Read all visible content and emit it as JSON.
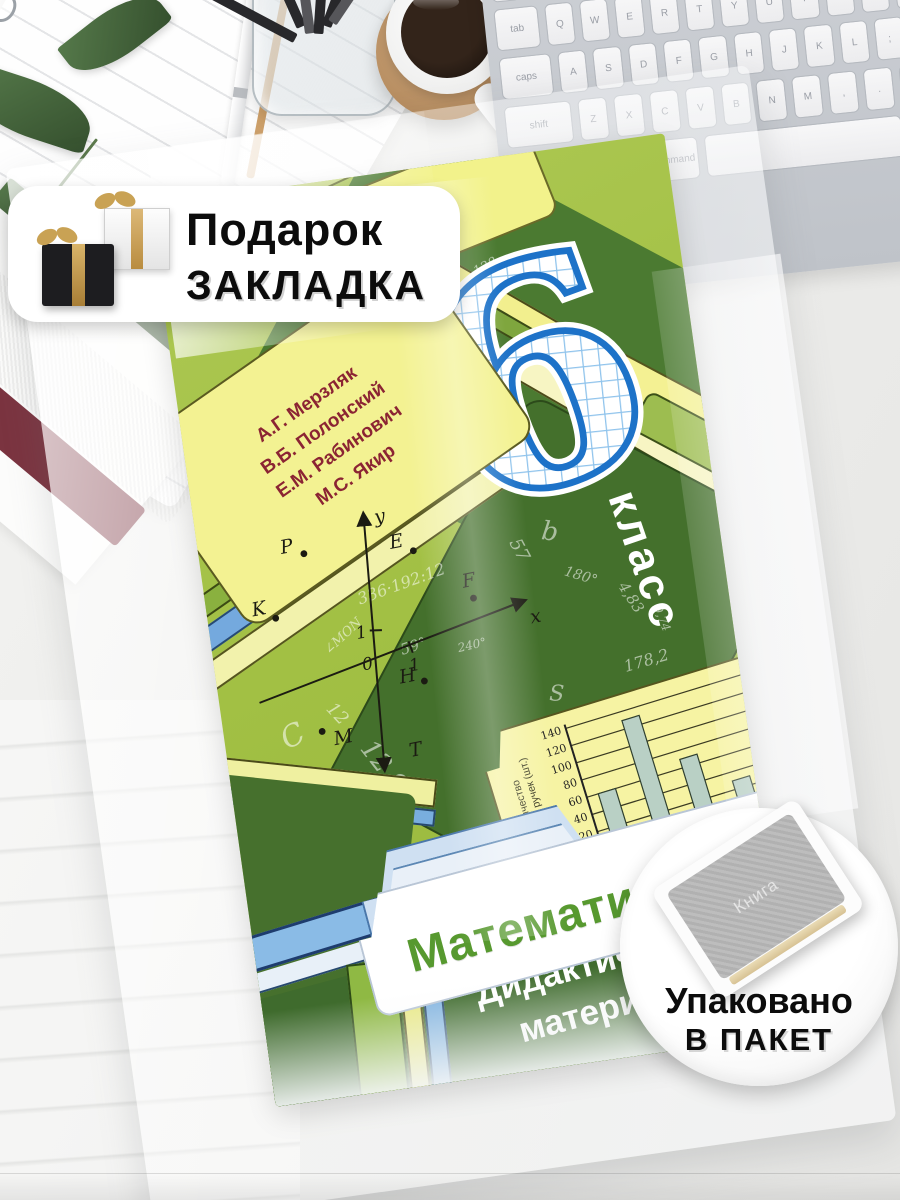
{
  "gift_badge": {
    "line1": "Подарок",
    "line2": "ЗАКЛАДКА"
  },
  "package_badge": {
    "line1": "Упаковано",
    "line2": "В ПАКЕТ",
    "wrapped_book_label": "Книга"
  },
  "book_cover": {
    "grade_number": "6",
    "grade_word": "класс",
    "authors": [
      "А.Г. Мерзляк",
      "В.Б. Полонский",
      "Е.М. Рабинович",
      "М.С. Якир"
    ],
    "title": "Математика",
    "subtitle_line1": "Дидактические",
    "subtitle_line2": "материалы",
    "plane": {
      "x_label": "x",
      "y_label": "y",
      "origin": "0",
      "unit_x": "1",
      "unit_y": "1",
      "points": [
        {
          "n": "P",
          "x": 80,
          "y": 40,
          "lx": -22,
          "ly": -4
        },
        {
          "n": "E",
          "x": 188,
          "y": 58,
          "lx": -22,
          "ly": -6
        },
        {
          "n": "K",
          "x": 40,
          "y": 98,
          "lx": -22,
          "ly": -6
        },
        {
          "n": "F",
          "x": 238,
          "y": 116,
          "lx": -8,
          "ly": -12
        },
        {
          "n": "H",
          "x": 174,
          "y": 188,
          "lx": -24,
          "ly": -2
        },
        {
          "n": "M",
          "x": 64,
          "y": 218,
          "lx": 10,
          "ly": 16
        },
        {
          "n": "T",
          "x": 134,
          "y": 254,
          "lx": 12,
          "ly": 6,
          "dot": false
        }
      ]
    },
    "bar_chart": {
      "ylabel_line1": "Количество",
      "ylabel_line2": "цветных ручек (шт.)",
      "y_ticks": [
        140,
        120,
        100,
        80,
        60,
        40,
        20
      ],
      "values": [
        60,
        130,
        70,
        30,
        65
      ]
    },
    "scatter_symbols": [
      {
        "t": "91,38",
        "x": 42,
        "y": 21,
        "r": -25,
        "s": 13
      },
      {
        "t": "128",
        "x": 60,
        "y": 11,
        "r": -20,
        "s": 13
      },
      {
        "t": "3,7",
        "x": 36,
        "y": 26,
        "r": -15,
        "s": 20
      },
      {
        "t": "189,3",
        "x": 50,
        "y": 31,
        "r": -8,
        "s": 22
      },
      {
        "t": "80 дм²",
        "x": 43,
        "y": 36,
        "r": -10,
        "s": 15
      },
      {
        "t": "7",
        "x": 27,
        "y": 33,
        "r": -60,
        "s": 30
      },
      {
        "t": "336·192:12",
        "x": 29,
        "y": 44,
        "r": -12,
        "s": 16
      },
      {
        "t": "∠MON",
        "x": 21,
        "y": 49,
        "r": -35,
        "s": 13
      },
      {
        "t": "57",
        "x": 59,
        "y": 42,
        "r": 70,
        "s": 18
      },
      {
        "t": "b",
        "x": 66,
        "y": 40,
        "r": 15,
        "s": 26
      },
      {
        "t": "180°",
        "x": 69,
        "y": 46,
        "r": 25,
        "s": 14
      },
      {
        "t": "4,83",
        "x": 78,
        "y": 49,
        "r": 65,
        "s": 15
      },
      {
        "t": "9,74",
        "x": 84,
        "y": 52,
        "r": 75,
        "s": 12
      },
      {
        "t": "178,2",
        "x": 78,
        "y": 56,
        "r": -8,
        "s": 16
      },
      {
        "t": "59°",
        "x": 36,
        "y": 51,
        "r": -10,
        "s": 15
      },
      {
        "t": "240°",
        "x": 47,
        "y": 52,
        "r": -5,
        "s": 12
      },
      {
        "t": "12",
        "x": 20,
        "y": 57,
        "r": 55,
        "s": 18
      },
      {
        "t": "C",
        "x": 11,
        "y": 58,
        "r": -20,
        "s": 30
      },
      {
        "t": "8",
        "x": 8,
        "y": 44,
        "r": 10,
        "s": 16
      },
      {
        "t": "12,9",
        "x": 24,
        "y": 63,
        "r": 60,
        "s": 26
      },
      {
        "t": "6,3",
        "x": 21,
        "y": 70,
        "r": 20,
        "s": 18
      },
      {
        "t": "q",
        "x": 14,
        "y": 66,
        "r": 0,
        "s": 18
      },
      {
        "t": "S",
        "x": 63,
        "y": 58,
        "r": 10,
        "s": 22
      },
      {
        "t": "150",
        "x": 83,
        "y": 63,
        "r": -12,
        "s": 16
      },
      {
        "t": "67,86",
        "x": 89,
        "y": 65,
        "r": -10,
        "s": 15
      },
      {
        "t": "38,04",
        "x": 87,
        "y": 72,
        "r": -8,
        "s": 12
      },
      {
        "t": "172,85",
        "x": 59,
        "y": 76,
        "r": -30,
        "s": 13
      },
      {
        "t": "398",
        "x": 33,
        "y": 76,
        "r": 80,
        "s": 14
      },
      {
        "t": "2,395",
        "x": 41,
        "y": 79,
        "r": 75,
        "s": 12
      },
      {
        "t": "m",
        "x": 39,
        "y": 83,
        "r": -15,
        "s": 20
      },
      {
        "t": "∠MON",
        "x": 46,
        "y": 86,
        "r": -5,
        "s": 13
      },
      {
        "t": "135°",
        "x": 10,
        "y": 75,
        "r": 30,
        "s": 13
      },
      {
        "t": "a",
        "x": 86,
        "y": 80,
        "r": 0,
        "s": 18
      }
    ]
  },
  "keyboard": {
    "rows": [
      [
        [
          "~",
          1
        ],
        [
          "1",
          1
        ],
        [
          "2",
          1
        ],
        [
          "3",
          1
        ],
        [
          "4",
          1
        ],
        [
          "5",
          1
        ],
        [
          "6",
          1
        ],
        [
          "7",
          1
        ],
        [
          "8",
          1
        ],
        [
          "9",
          1
        ],
        [
          "0",
          1
        ],
        [
          "-",
          1
        ],
        [
          "=",
          1
        ],
        [
          "delete",
          1.6
        ]
      ],
      [
        [
          "tab",
          1.6
        ],
        [
          "Q",
          1
        ],
        [
          "W",
          1
        ],
        [
          "E",
          1
        ],
        [
          "R",
          1
        ],
        [
          "T",
          1
        ],
        [
          "Y",
          1
        ],
        [
          "U",
          1
        ],
        [
          "I",
          1
        ],
        [
          "O",
          1
        ],
        [
          "P",
          1
        ],
        [
          "[",
          1
        ],
        [
          "]",
          1
        ],
        [
          "\\",
          1
        ]
      ],
      [
        [
          "caps",
          1.9
        ],
        [
          "A",
          1
        ],
        [
          "S",
          1
        ],
        [
          "D",
          1
        ],
        [
          "F",
          1
        ],
        [
          "G",
          1
        ],
        [
          "H",
          1
        ],
        [
          "J",
          1
        ],
        [
          "K",
          1
        ],
        [
          "L",
          1
        ],
        [
          ";",
          1
        ],
        [
          "'",
          1
        ],
        [
          "return",
          1.9
        ]
      ],
      [
        [
          "shift",
          2.4
        ],
        [
          "Z",
          1
        ],
        [
          "X",
          1
        ],
        [
          "C",
          1
        ],
        [
          "V",
          1
        ],
        [
          "B",
          1
        ],
        [
          "N",
          1
        ],
        [
          "M",
          1
        ],
        [
          ",",
          1
        ],
        [
          ".",
          1
        ],
        [
          "/",
          1
        ],
        [
          "shift",
          2.4
        ]
      ],
      [
        [
          "fn",
          1
        ],
        [
          "control",
          1.2
        ],
        [
          "option",
          1.2
        ],
        [
          "command",
          1.5
        ],
        [
          "",
          6
        ],
        [
          "command",
          1.5
        ],
        [
          "option",
          1.2
        ]
      ]
    ]
  },
  "chart_data": [
    {
      "type": "bar",
      "title": "Bar chart printed on book cover tab",
      "categories": [
        "1",
        "2",
        "3",
        "4",
        "5"
      ],
      "values": [
        60,
        130,
        70,
        30,
        65
      ],
      "xlabel": "",
      "ylabel": "Количество цветных ручек (шт.)",
      "ylim": [
        0,
        140
      ],
      "y_ticks": [
        20,
        40,
        60,
        80,
        100,
        120,
        140
      ],
      "grid": true,
      "legend_position": "none"
    },
    {
      "type": "scatter",
      "title": "Coordinate plane printed on book cover",
      "xlabel": "x",
      "ylabel": "y",
      "points": [
        {
          "label": "P",
          "x": -1.5,
          "y": 3
        },
        {
          "label": "E",
          "x": 1.5,
          "y": 2.5
        },
        {
          "label": "K",
          "x": -2.5,
          "y": 1.5
        },
        {
          "label": "F",
          "x": 3,
          "y": 0
        },
        {
          "label": "H",
          "x": 1,
          "y": -1
        },
        {
          "label": "M",
          "x": -2,
          "y": -2
        },
        {
          "label": "T",
          "x": 0,
          "y": -3
        }
      ]
    }
  ],
  "colors": {
    "cover_green": "#a6c24b",
    "cover_dark_green": "#44702c",
    "tab_yellow": "#f2f08d",
    "stripe_blue": "#74aade",
    "digit_blue": "#1d72c8",
    "title_green": "#57992f",
    "authors_red": "#8b2433",
    "subtitle_band": "#3f6b2d",
    "bar_fill": "#b9d0c5"
  }
}
